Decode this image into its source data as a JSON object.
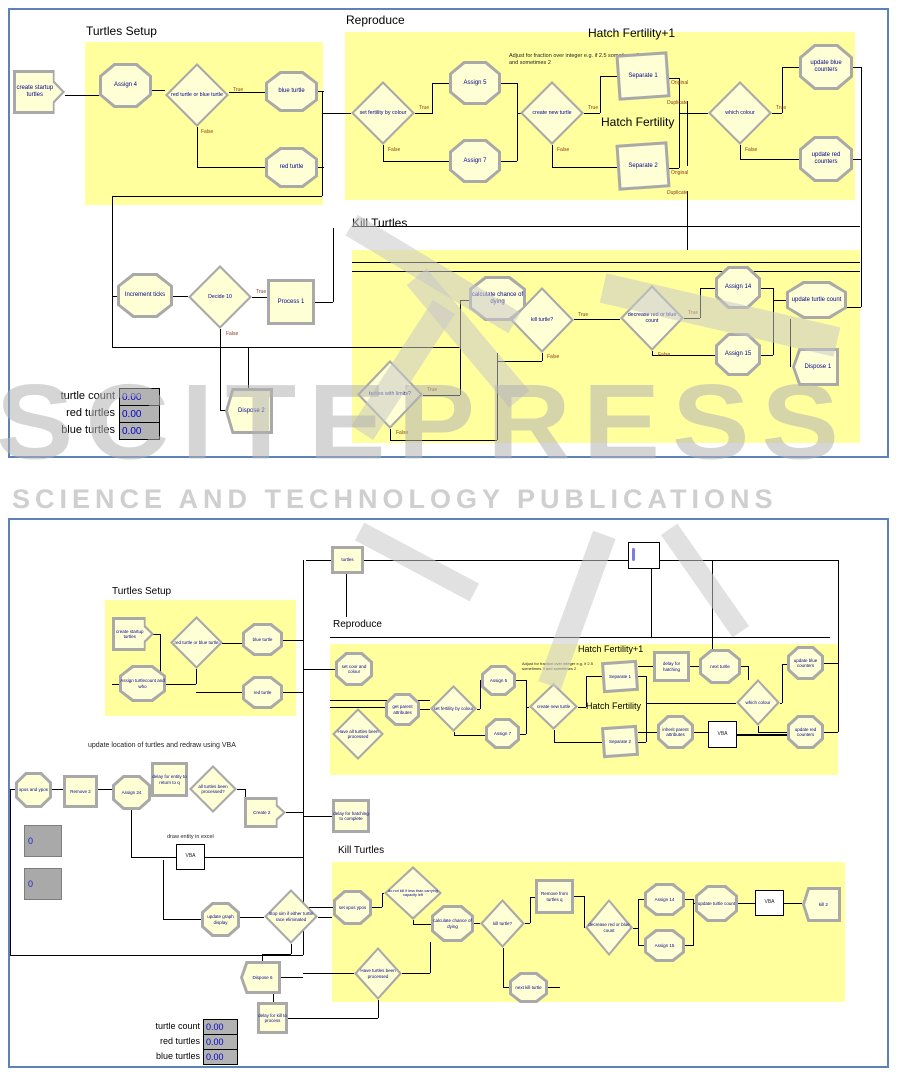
{
  "watermark": {
    "brand": "SCITEPRESS",
    "tagline": "SCIENCE AND TECHNOLOGY PUBLICATIONS"
  },
  "ports": {
    "t": "True",
    "f": "False",
    "o": "Original",
    "d": "Duplicate"
  },
  "top": {
    "titles": {
      "setup": "Turtles Setup",
      "reproduce": "Reproduce",
      "hatch_plus": "Hatch Fertility+1",
      "hatch": "Hatch Fertility",
      "kill": "Kill Turtles"
    },
    "annotation": "Adjust for fraction over integer e.g. if 2.5 sometimes 3 and sometimes 2",
    "nodes": {
      "create_startup": "create startup turtles",
      "assign4": "Assign 4",
      "red_or_blue": "red turtle or blue turtle",
      "blue_turtle": "blue turtle",
      "red_turtle": "red turtle",
      "set_fertility": "set fertility by colour",
      "assign5": "Assign 5",
      "assign7": "Assign 7",
      "create_new": "create new turtle",
      "separate1": "Separate 1",
      "separate2": "Separate 2",
      "which_colour": "which colour",
      "update_blue": "update blue counters",
      "update_red": "update red counters",
      "increment_ticks": "Increment ticks",
      "decide10": "Decide 10",
      "process1": "Process 1",
      "calc_chance": "calculate chance of dying",
      "kill_turtle": "kill turtle?",
      "decrease": "decrease red or blue count",
      "assign14": "Assign 14",
      "assign15": "Assign 15",
      "update_count": "update turtle count",
      "dispose1": "Dispose 1",
      "turtles_limits": "turtles with limits?",
      "dispose2": "Dispose 2"
    },
    "counters": [
      {
        "label": "turtle count",
        "value": "0.00"
      },
      {
        "label": "red turtles",
        "value": "0.00"
      },
      {
        "label": "blue turtles",
        "value": "0.00"
      }
    ]
  },
  "bottom": {
    "titles": {
      "setup": "Turtles Setup",
      "reproduce": "Reproduce",
      "hatch_plus": "Hatch Fertility+1",
      "hatch": "Hatch Fertility",
      "kill": "Kill Turtles"
    },
    "annotation": "Adjust for fraction over integer e.g. if 2.5 sometimes 3 and sometimes 2",
    "labels": {
      "turtles": "turtles",
      "update_location": "update location of turtles and redraw using VBA",
      "draw_entity": "draw entity in excel"
    },
    "nodes": {
      "create_startup": "create startup turtles",
      "assign_turtlecount": "Assign turtlecount and who",
      "red_or_blue": "red turtle or blue turtle",
      "blue_turtle": "blue turtle",
      "red_turtle": "red turtle",
      "set_coor": "set coor and colour",
      "have_all_processed": "Have all turtles been processed",
      "get_parent": "get parent attributes",
      "set_fertility": "set fertility by colour",
      "assign5": "Assign 5",
      "assign7": "Assign 7",
      "create_new": "create new turtle",
      "separate1": "Separate 1",
      "separate2": "Separate 2",
      "delay_hatching": "delay for hatching",
      "next_turtle": "next turtle",
      "which_colour": "which colour",
      "update_blue": "update blue counters",
      "inherit_parent": "inherit parent attributes",
      "vba": "VBA",
      "update_red": "update red counters",
      "xpos_ypos": "xpos and ypos",
      "remove2": "Remove 2",
      "assign24": "Assign 24",
      "delay_entity": "delay for entity to return to q",
      "all_processed": "all turtles been processed?",
      "create2": "Create 2",
      "delay_hatch_complete": "delay for hatching to complete",
      "set_xpos": "set xpos ypos",
      "do_not_kill": "do not kill if less than carrying capacity left",
      "calc_chance": "calculate chance of dying",
      "kill_turtle": "kill turtle?",
      "remove_from_q": "Remove from turtles q",
      "decrease": "decrease red or blue count",
      "have_processed": "Have turtles been processed",
      "next_kill": "next kill turtle",
      "assign14": "Assign 14",
      "assign15": "Assign 15",
      "update_count": "update turtle count",
      "kill2": "kill 2",
      "update_graph": "update graph display",
      "stop_sim": "stop sim if either turtle race eliminated",
      "dispose6": "Dispose 6",
      "delay_kill": "delay for kill to process"
    },
    "gray_counters": [
      "0",
      "0"
    ],
    "counters": [
      {
        "label": "turtle count",
        "value": "0.00"
      },
      {
        "label": "red turtles",
        "value": "0.00"
      },
      {
        "label": "blue turtles",
        "value": "0.00"
      }
    ]
  }
}
